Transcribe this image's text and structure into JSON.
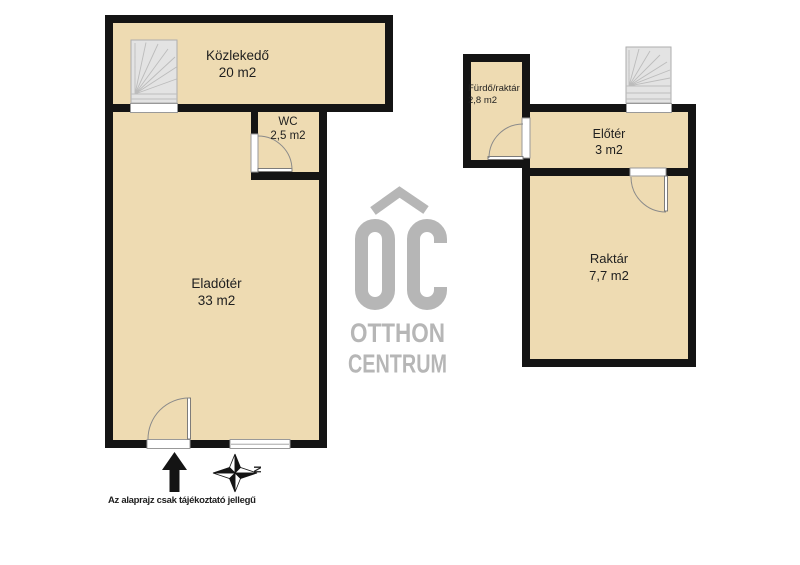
{
  "colors": {
    "wall": "#141414",
    "floor": "#eedbb2",
    "stairs": "#e3e3e3",
    "stair-line": "#bcbcbc",
    "opening-line": "#999999",
    "door-line": "#8a8a8a",
    "label": "#1f1f1f",
    "logo": "#b6b6b6"
  },
  "plans": {
    "left": {
      "rooms": {
        "kozlekedo": {
          "name": "Közlekedő",
          "area": "20 m2"
        },
        "wc": {
          "name": "WC",
          "area": "2,5 m2"
        },
        "eladoter": {
          "name": "Eladótér",
          "area": "33 m2"
        }
      }
    },
    "right": {
      "rooms": {
        "furdo": {
          "name": "Fürdő/raktár",
          "area": "2,8 m2"
        },
        "eloter": {
          "name": "Előtér",
          "area": "3 m2"
        },
        "raktar": {
          "name": "Raktár",
          "area": "7,7 m2"
        }
      }
    }
  },
  "logo": {
    "monogram": "OC",
    "line1": "OTTHON",
    "line2": "CENTRUM"
  },
  "compass": {
    "north": "N"
  },
  "footer": {
    "disclaimer": "Az alaprajz csak tájékoztató jellegű"
  }
}
